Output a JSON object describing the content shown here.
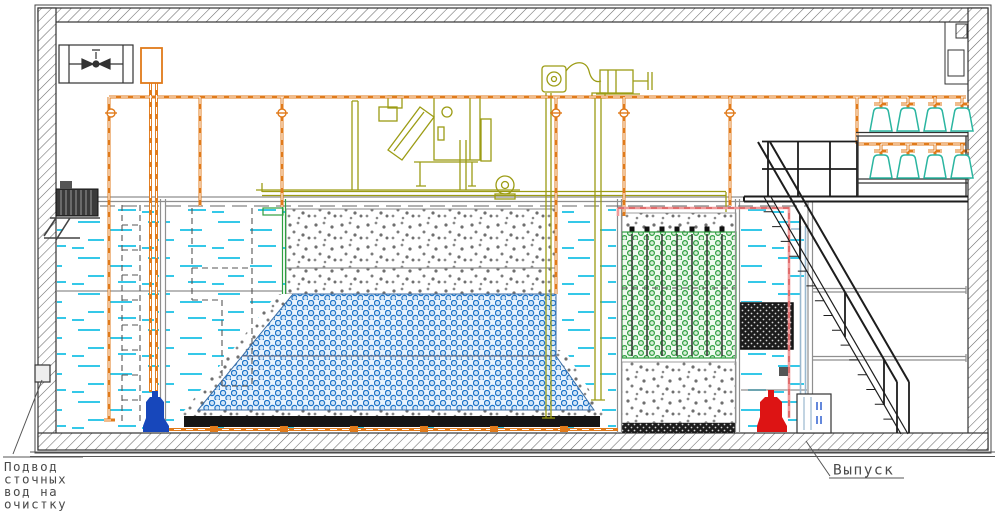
{
  "diagram": {
    "kind": "sectional CAD drawing of a packaged wastewater treatment plant",
    "callouts": {
      "inlet": {
        "lines": [
          "Подвод",
          "сточных",
          "вод на",
          "очистку"
        ]
      },
      "outlet": {
        "text": "Выпуск"
      }
    },
    "colors": {
      "orange": "#e07a1a",
      "olive": "#9c9c14",
      "teal": "#2ab5a0",
      "water": "#35c8e8",
      "pink": "#f09a9a",
      "bluegray": "#9ab8cf",
      "green": "#2e9e40",
      "blue": "#1e74c8",
      "pump_blue": "#1747bb",
      "pump_red": "#dd1414",
      "ink": "#1d1d1d",
      "gray": "#8f8f8f"
    }
  }
}
